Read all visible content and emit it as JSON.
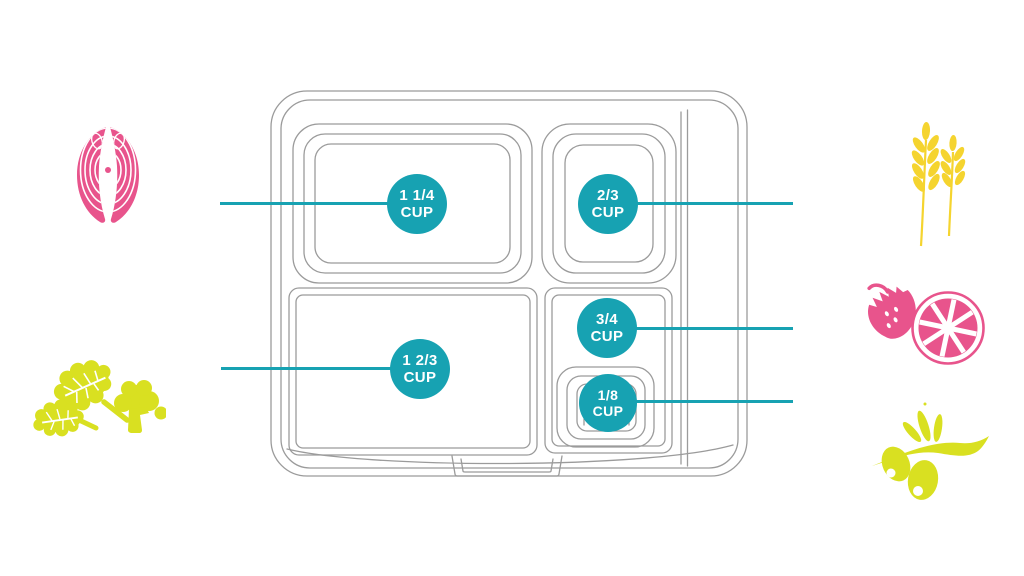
{
  "colors": {
    "teal": "#17A2B2",
    "pink": "#E8548C",
    "yellow": "#F5D42F",
    "lime": "#D9E021",
    "outline": "#9B9B9B",
    "background": "#FFFFFF"
  },
  "badges": [
    {
      "id": "top-left-compartment",
      "amount": "1 1/4",
      "unit": "CUP"
    },
    {
      "id": "top-right-compartment",
      "amount": "2/3",
      "unit": "CUP"
    },
    {
      "id": "middle-right-compartment",
      "amount": "3/4",
      "unit": "CUP"
    },
    {
      "id": "small-right-compartment",
      "amount": "1/8",
      "unit": "CUP"
    },
    {
      "id": "bottom-left-compartment",
      "amount": "1 2/3",
      "unit": "CUP"
    }
  ],
  "icons": [
    {
      "name": "salmon-fillet-icon",
      "color": "#E8548C"
    },
    {
      "name": "wheat-stalks-icon",
      "color": "#F5D42F"
    },
    {
      "name": "strawberry-icon",
      "color": "#E8548C"
    },
    {
      "name": "citrus-slice-icon",
      "color": "#E8548C"
    },
    {
      "name": "leafy-greens-icon",
      "color": "#D9E021"
    },
    {
      "name": "broccoli-icon",
      "color": "#D9E021"
    },
    {
      "name": "olive-branch-icon",
      "color": "#D9E021"
    }
  ]
}
